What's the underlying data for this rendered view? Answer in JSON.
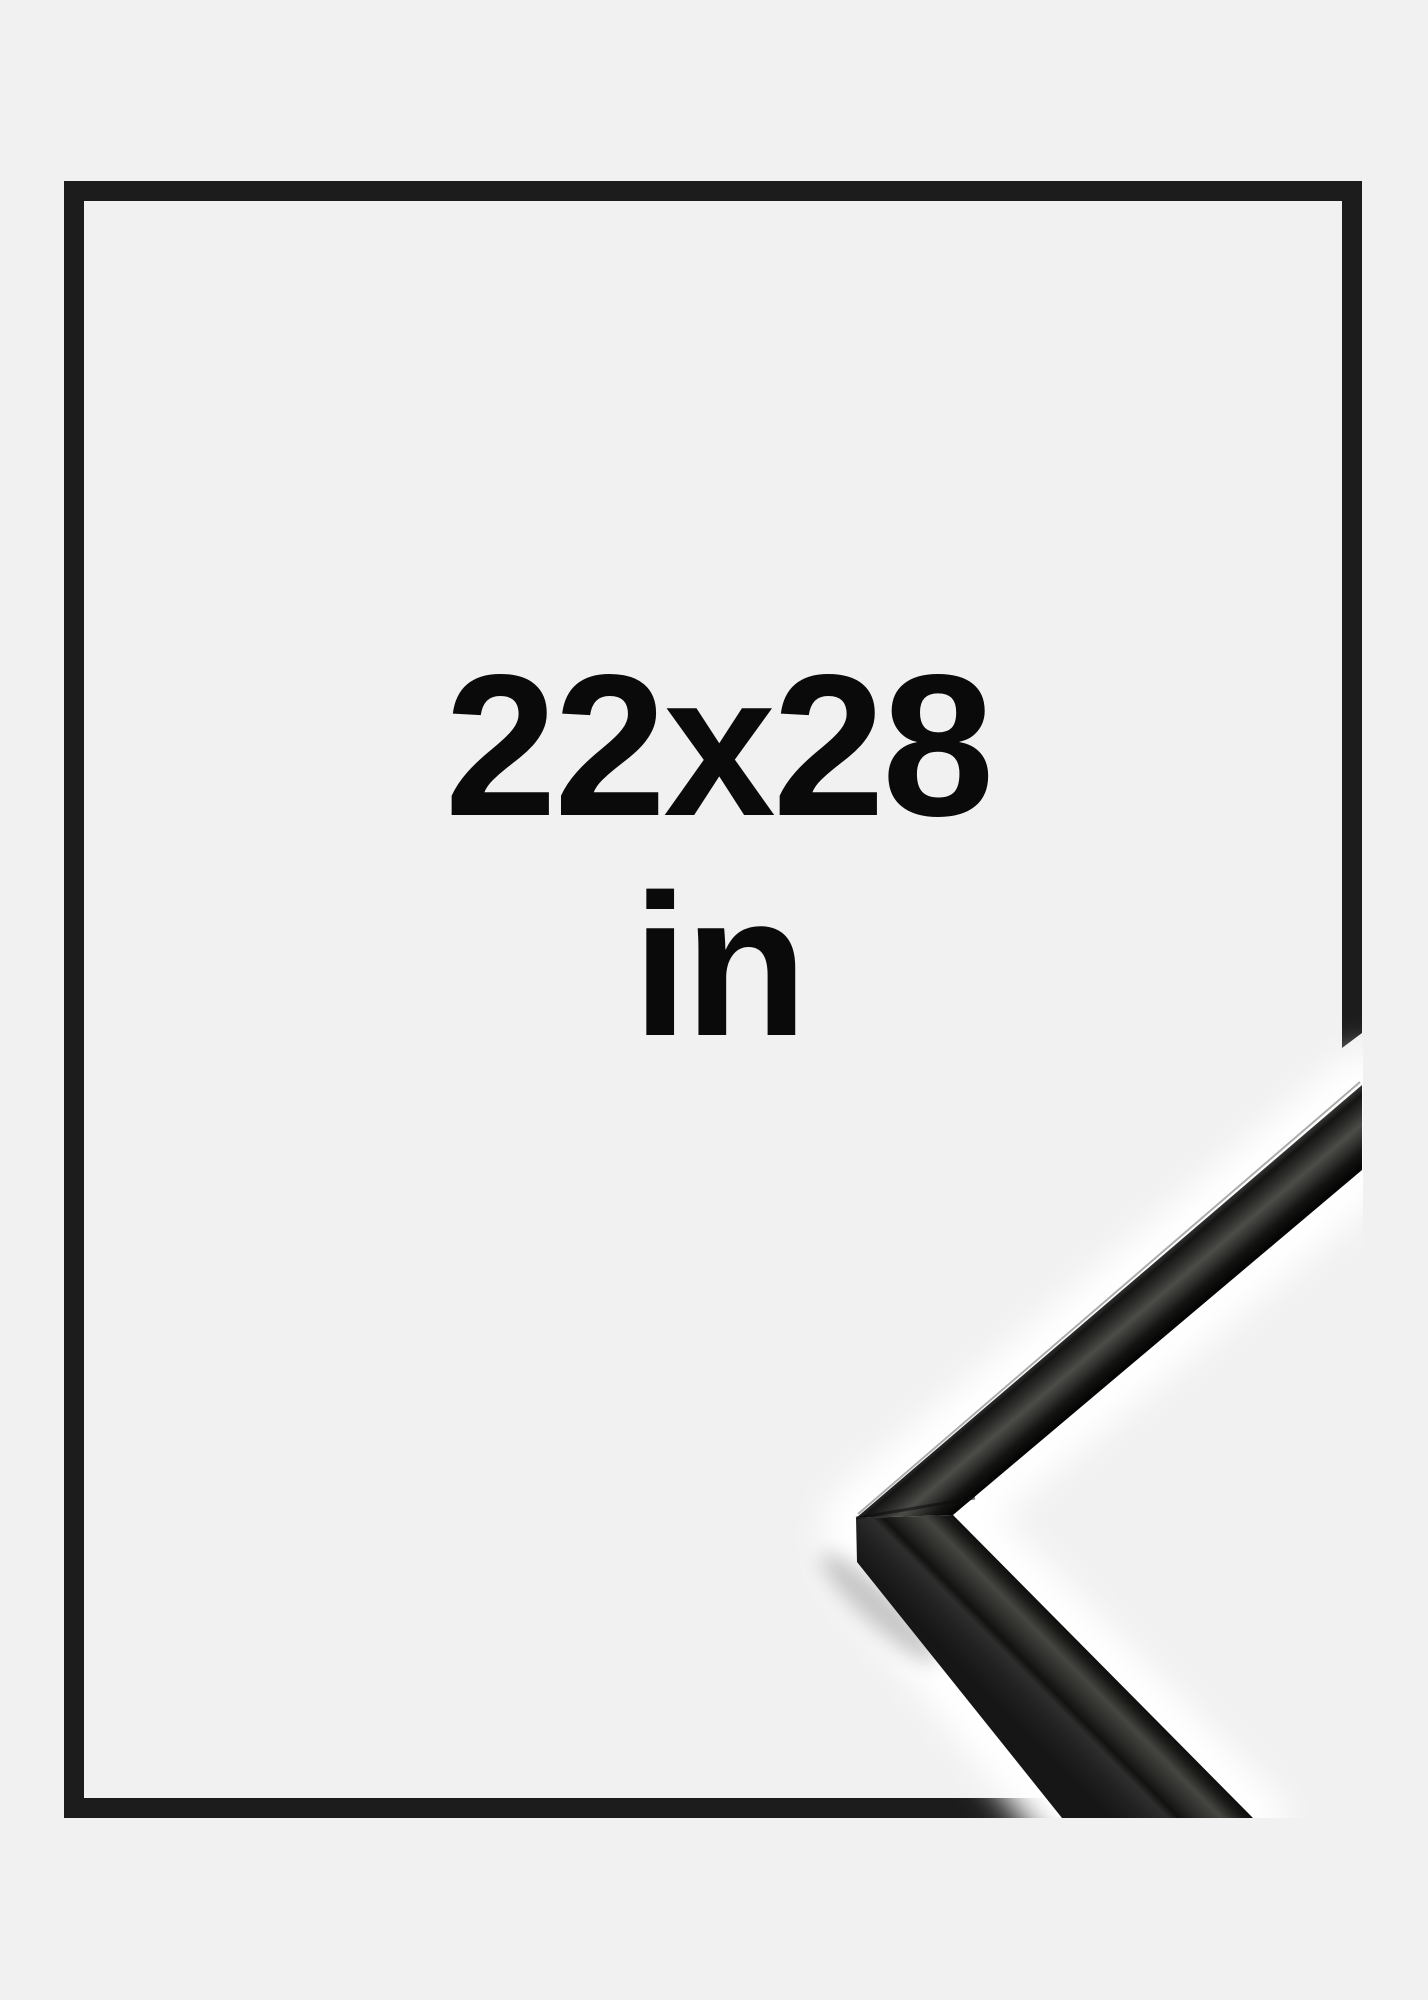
{
  "label": {
    "size": "22x28",
    "unit": "in"
  },
  "colors": {
    "background": "#f1f1f2",
    "frame": "#1c1c1c",
    "text": "#0a0a0a",
    "halo": "#ffffff",
    "profile_dark": "#0d0d0d",
    "profile_sheen": "#4c4c48"
  }
}
